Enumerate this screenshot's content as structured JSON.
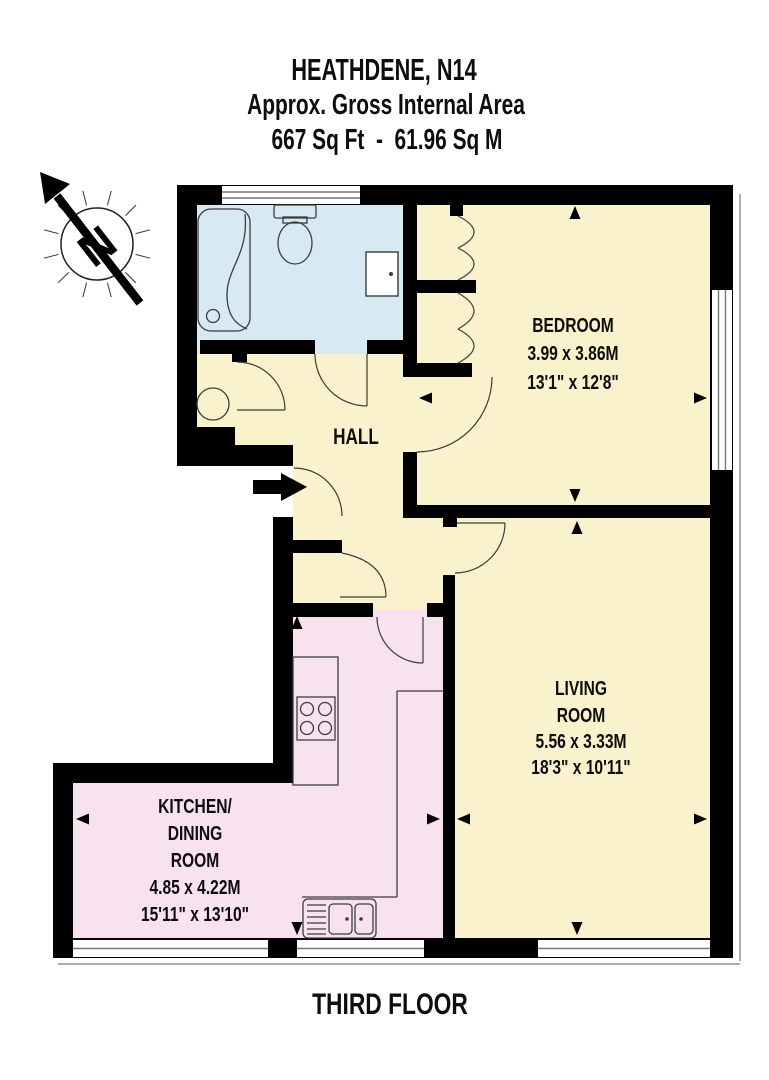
{
  "title": {
    "line1": "HEATHDENE, N14",
    "line2": "Approx. Gross Internal Area",
    "line3": "667 Sq Ft  -  61.96 Sq M"
  },
  "floor_label": "THIRD FLOOR",
  "compass": {
    "letter": "N"
  },
  "rooms": {
    "hall": {
      "name": "HALL"
    },
    "bedroom": {
      "name": "BEDROOM",
      "size_metric": "3.99 x 3.86M",
      "size_imperial": "13'1\" x 12'8\""
    },
    "living": {
      "name_line1": "LIVING",
      "name_line2": "ROOM",
      "size_metric": "5.56 x 3.33M",
      "size_imperial": "18'3\" x 10'11\""
    },
    "kitchen": {
      "name_line1": "KITCHEN/",
      "name_line2": "DINING",
      "name_line3": "ROOM",
      "size_metric": "4.85 x 4.22M",
      "size_imperial": "15'11\" x 13'10\""
    }
  },
  "colors": {
    "c-room-yellow": "#FAF2CC",
    "c-room-blue": "#D7E9F3",
    "c-room-pink": "#F8E2EF",
    "c-wall": "#000000",
    "c-line": "#3C3C3C",
    "c-shadow": "#ADADAD"
  }
}
